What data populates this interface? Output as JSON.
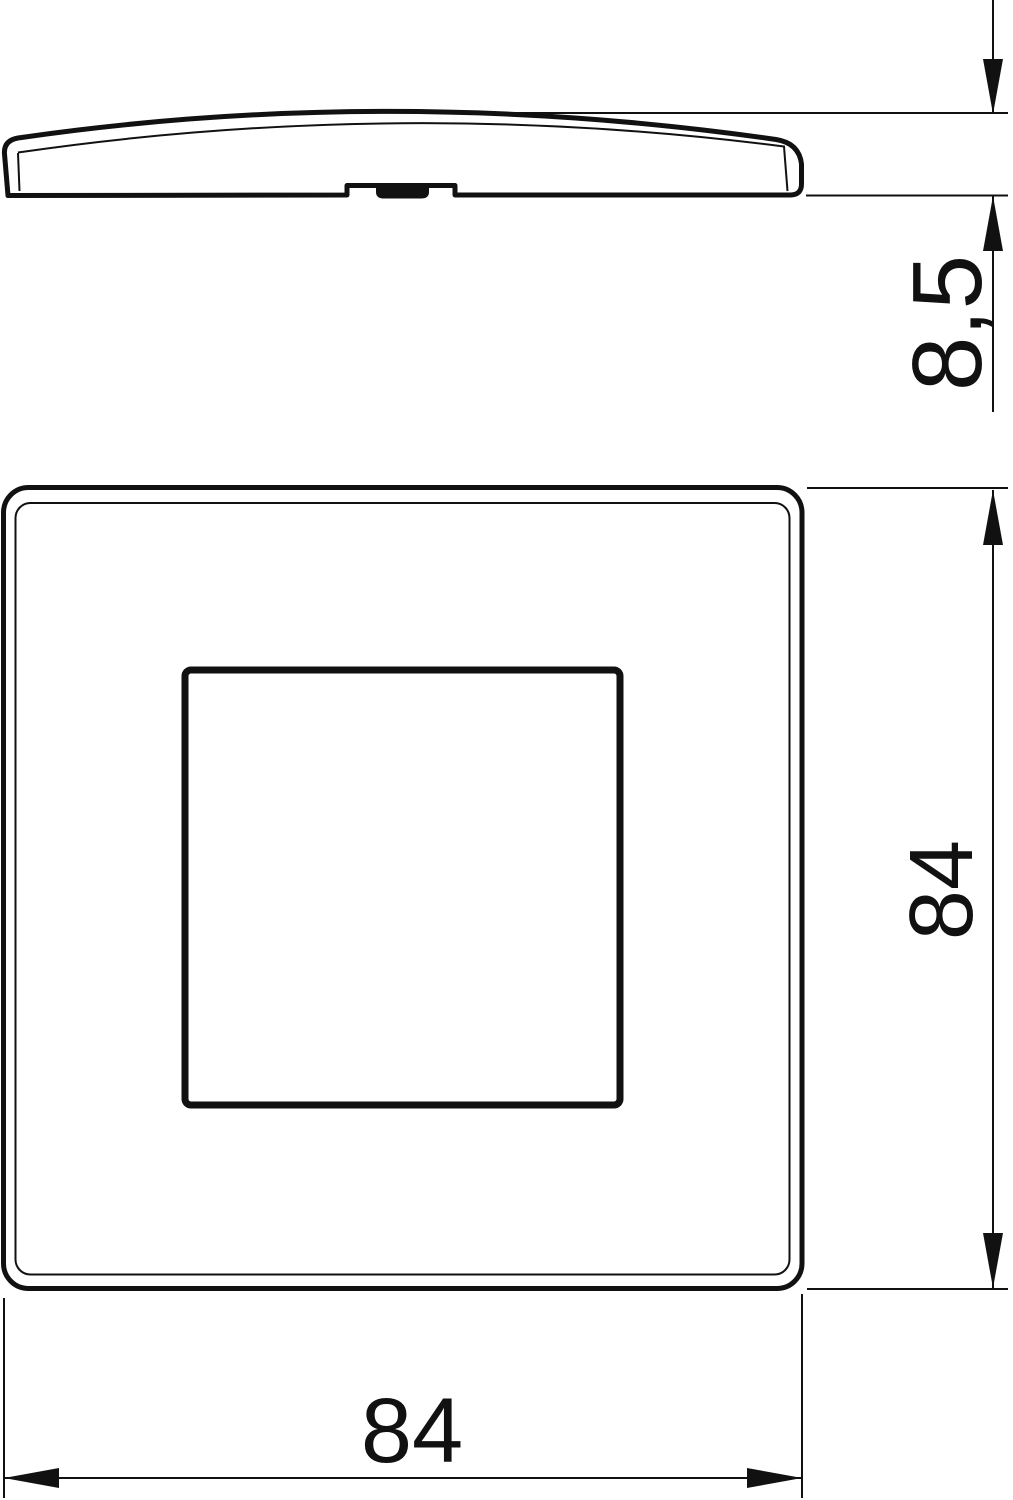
{
  "drawing": {
    "side_view": {
      "name": "cover-plate-side-profile",
      "thickness_dim": {
        "label": "8,5"
      }
    },
    "front_view": {
      "name": "cover-plate-front",
      "height_dim": {
        "label": "84"
      },
      "width_dim": {
        "label": "84"
      }
    },
    "colors": {
      "line": "#111111",
      "background": "#ffffff"
    }
  }
}
